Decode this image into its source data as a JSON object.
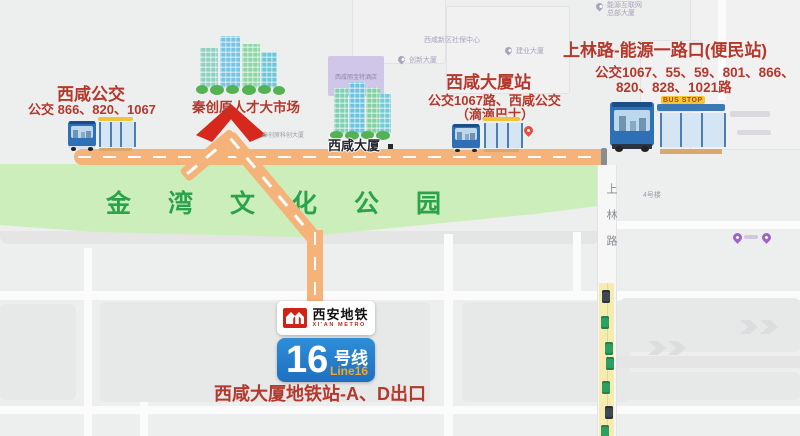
{
  "stops": {
    "xixian_bus": {
      "title": "西咸公交",
      "routes": "公交 866、820、1067"
    },
    "xixian_tower_station": {
      "title": "西咸大厦站",
      "routes": "公交1067路、西咸公交",
      "note": "（滴滴巴士）"
    },
    "shanglin_energy": {
      "title": "上林路-能源一路口(便民站)",
      "routes_line1": "公交1067、55、59、801、866、",
      "routes_line2": "820、828、1021路"
    }
  },
  "landmarks": {
    "talent_market": "秦创原人才大市场",
    "park": "金湾文化公园",
    "xixian_tower": "西咸大厦",
    "hotel_faint": "西咸丽宝特酒店",
    "sci_tower_faint": "秦创原科创大厦",
    "social_security_faint": "西咸新区社保中心",
    "jianye_faint": "建业大厦",
    "chuangxin_faint": "创新大厦",
    "hq_faint_line1": "能源互联网",
    "hq_faint_line2": "总部大厦",
    "building4_faint": "4号楼"
  },
  "roads": {
    "shanglin_vertical": "上林路",
    "bus_stop_sign": "BUS STOP"
  },
  "metro": {
    "brand_cn": "西安地铁",
    "brand_en": "XI'AN METRO",
    "line_number": "16",
    "line_unit": "号线",
    "line_en": "Line16",
    "exit_note": "西咸大厦地铁站-A、D出口"
  },
  "colors": {
    "accent_red": "#b5382c",
    "road_orange": "#f5b379",
    "park_green": "#cceebb",
    "park_text_green": "#2ba24c",
    "metro_blue": "#2181cd",
    "line_en_orange": "#f6a81c",
    "logo_red": "#cf2318",
    "traffic_yellow": "#f7ecb0"
  }
}
